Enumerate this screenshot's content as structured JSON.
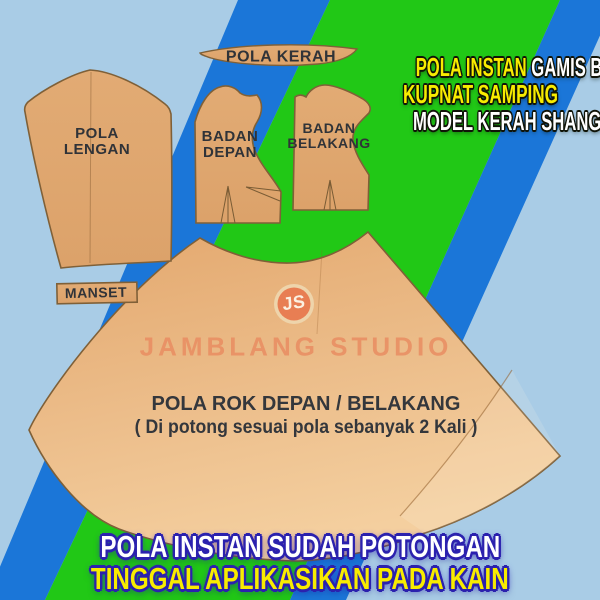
{
  "header": {
    "line1_highlight": "POLA INSTAN",
    "line1_rest": " GAMIS BUSUI",
    "line2": "KUPNAT SAMPING",
    "line3": "MODEL KERAH SHANGHAI"
  },
  "pieces": {
    "collar_label": "POLA KERAH",
    "sleeve_label_line1": "POLA",
    "sleeve_label_line2": "LENGAN",
    "front_bodice_label_line1": "BADAN",
    "front_bodice_label_line2": "DEPAN",
    "back_bodice_label_line1": "BADAN",
    "back_bodice_label_line2": "BELAKANG",
    "cuff_label": "MANSET",
    "skirt_label_line1": "POLA ROK DEPAN / BELAKANG",
    "skirt_label_line2": "( Di potong sesuai pola sebanyak 2 Kali )"
  },
  "logo": {
    "monogram": "JS",
    "studio_name": "JAMBLANG STUDIO"
  },
  "footer": {
    "line1": "POLA INSTAN SUDAH POTONGAN",
    "line2": "TINGGAL APLIKASIKAN PADA KAIN"
  },
  "colors": {
    "background_light_blue": "#a9cce6",
    "band_blue": "#1b76d8",
    "band_green": "#21c816",
    "paper_tan": "#e0a76f",
    "paper_outline": "#7f6038",
    "label_ink": "#303338",
    "accent_yellow": "#f8ec00",
    "accent_white": "#ffffff",
    "footer_outline_indigo": "#2b21ae",
    "logo_salmon": "#e87e53"
  }
}
